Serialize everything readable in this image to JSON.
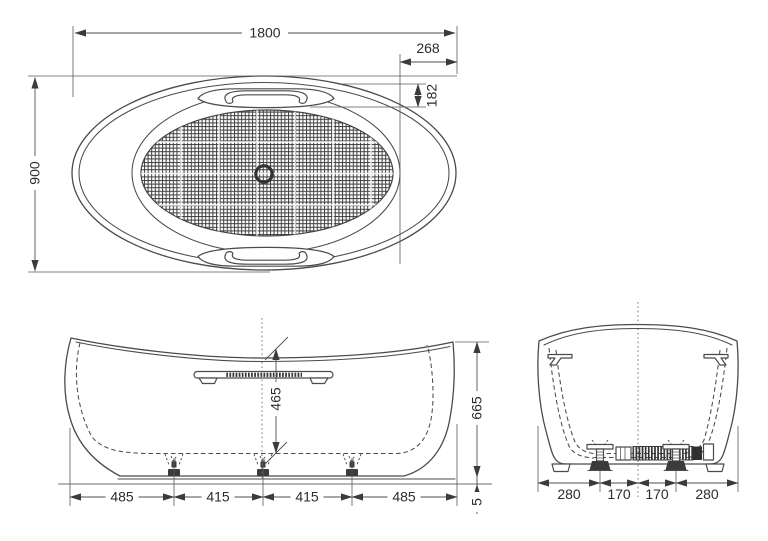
{
  "colors": {
    "line": "#4b4b4b",
    "text": "#2b2b2b",
    "background": "#ffffff"
  },
  "top_view": {
    "length": "1800",
    "width": "900",
    "end_inset": "268",
    "handle_recess": "182"
  },
  "front_view": {
    "inner_depth": "465",
    "overall_height": "665",
    "floor_gap": "5",
    "foot_spacing": [
      "485",
      "415",
      "415",
      "485"
    ]
  },
  "end_view": {
    "foot_spacing": [
      "280",
      "170",
      "170",
      "280"
    ]
  }
}
